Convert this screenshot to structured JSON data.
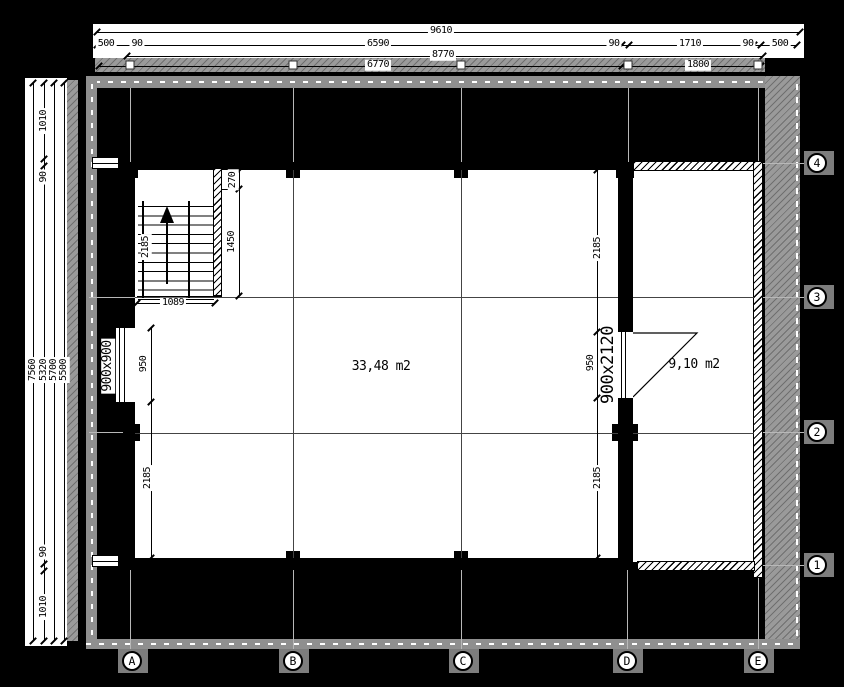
{
  "top": {
    "total": "9610",
    "c500a": "500",
    "c90a": "90",
    "c6590": "6590",
    "c90b": "90",
    "c1710": "1710",
    "c90c": "90",
    "c500b": "500",
    "mid": "8770",
    "b6770": "6770",
    "b1800": "1800"
  },
  "left": {
    "t7560": "7560",
    "t5320": "5320",
    "t5700": "5700",
    "t5500": "5500",
    "top1010": "1010",
    "top90": "90",
    "bot90": "90",
    "bot1010": "1010"
  },
  "plan": {
    "stair2185": "2185",
    "d270": "270",
    "d1450": "1450",
    "d1089": "1089",
    "leftDoor": "900x900",
    "left950": "950",
    "left2185": "2185",
    "right2185top": "2185",
    "right950": "950",
    "right2185bot": "2185",
    "rightDoor": "900x2120",
    "mainArea": "33,48 m2",
    "rightArea": "9,10 m2"
  },
  "grid": {
    "cols": [
      "A",
      "B",
      "C",
      "D",
      "E"
    ],
    "rows": [
      "4",
      "3",
      "2",
      "1"
    ]
  },
  "colors": {
    "paper": "#000000",
    "linework": "#ffffff",
    "dim_text": "#000000"
  }
}
